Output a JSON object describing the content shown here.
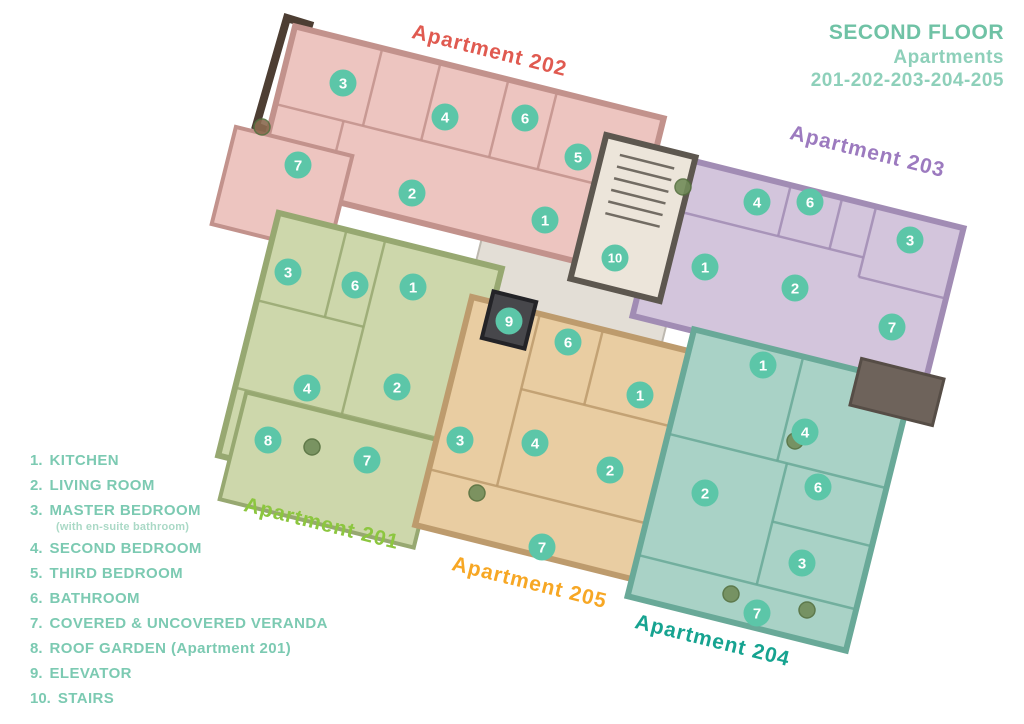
{
  "header": {
    "title": "SECOND FLOOR",
    "subtitle": "Apartments",
    "numbers": "201-202-203-204-205",
    "title_color": "#6fc2a5",
    "subtitle_color": "#8ed0ba"
  },
  "legend": {
    "color": "#7ccab2",
    "note_color": "#aad9c6",
    "items": [
      {
        "num": "1.",
        "text": "KITCHEN"
      },
      {
        "num": "2.",
        "text": "LIVING ROOM"
      },
      {
        "num": "3.",
        "text": "MASTER BEDROOM",
        "note": "(with en-suite bathroom)"
      },
      {
        "num": "4.",
        "text": "SECOND BEDROOM"
      },
      {
        "num": "5.",
        "text": "THIRD BEDROOM"
      },
      {
        "num": "6.",
        "text": "BATHROOM"
      },
      {
        "num": "7.",
        "text": "COVERED & UNCOVERED VERANDA"
      },
      {
        "num": "8.",
        "text": "ROOF GARDEN (Apartment 201)"
      },
      {
        "num": "9.",
        "text": "ELEVATOR"
      },
      {
        "num": "10.",
        "text": "STAIRS"
      }
    ]
  },
  "badge_style": {
    "fill": "#5cc6a8",
    "text_color": "#ffffff",
    "radius": 13.5
  },
  "floorplan": {
    "rotation_deg": 14,
    "context": [
      {
        "name": "common-corridor",
        "cx": 572,
        "cy": 290,
        "w": 200,
        "h": 100,
        "fill": "#e3ded6",
        "stroke": "#bdb8af"
      }
    ],
    "apartments": [
      {
        "id": "202",
        "label": "Apartment 202",
        "label_color": "#e05a50",
        "label_x": 488,
        "label_y": 57,
        "fill": "#edc5c0",
        "wall": "#c2928c",
        "cx": 460,
        "cy": 150,
        "w": 380,
        "h": 160,
        "wings": [
          {
            "cx": 282,
            "cy": 190,
            "w": 120,
            "h": 100
          }
        ],
        "dividers": [
          [
            -100,
            -80,
            -100,
            0
          ],
          [
            -40,
            -80,
            -40,
            0
          ],
          [
            30,
            -80,
            30,
            0
          ],
          [
            80,
            -80,
            80,
            0
          ],
          [
            -190,
            0,
            140,
            0
          ],
          [
            -120,
            0,
            -120,
            80
          ]
        ],
        "badges": [
          [
            "3",
            343,
            83
          ],
          [
            "4",
            445,
            117
          ],
          [
            "6",
            525,
            118
          ],
          [
            "5",
            578,
            157
          ],
          [
            "7",
            298,
            165
          ],
          [
            "2",
            412,
            193
          ],
          [
            "1",
            545,
            220
          ]
        ]
      },
      {
        "id": "203",
        "label": "Apartment 203",
        "label_color": "#9c7abf",
        "label_x": 866,
        "label_y": 158,
        "fill": "#d3c5dc",
        "wall": "#a18cb4",
        "cx": 798,
        "cy": 272,
        "w": 300,
        "h": 165,
        "wings": [],
        "dividers": [
          [
            -28,
            -82,
            -28,
            -30
          ],
          [
            25,
            -82,
            25,
            -30
          ],
          [
            -150,
            -30,
            60,
            -30
          ],
          [
            60,
            -82,
            60,
            -10
          ],
          [
            60,
            -10,
            150,
            -10
          ]
        ],
        "badges": [
          [
            "4",
            757,
            202
          ],
          [
            "6",
            810,
            202
          ],
          [
            "3",
            910,
            240
          ],
          [
            "1",
            705,
            267
          ],
          [
            "2",
            795,
            288
          ],
          [
            "7",
            892,
            327
          ]
        ]
      },
      {
        "id": "201",
        "label": "Apartment 201",
        "label_color": "#8cc63f",
        "label_x": 320,
        "label_y": 530,
        "fill": "#cdd7ab",
        "wall": "#97a871",
        "cx": 360,
        "cy": 362,
        "w": 230,
        "h": 250,
        "wings": [
          {
            "cx": 330,
            "cy": 470,
            "w": 200,
            "h": 110
          }
        ],
        "dividers": [
          [
            -115,
            -35,
            -5,
            -35
          ],
          [
            -45,
            -125,
            -45,
            -35
          ],
          [
            -5,
            -125,
            -5,
            55
          ],
          [
            -115,
            55,
            115,
            55
          ]
        ],
        "badges": [
          [
            "3",
            288,
            272
          ],
          [
            "6",
            355,
            285
          ],
          [
            "1",
            413,
            287
          ],
          [
            "4",
            307,
            388
          ],
          [
            "2",
            397,
            387
          ],
          [
            "8",
            268,
            440
          ],
          [
            "7",
            367,
            460
          ]
        ]
      },
      {
        "id": "205",
        "label": "Apartment 205",
        "label_color": "#f7a724",
        "label_x": 528,
        "label_y": 589,
        "fill": "#e9cda2",
        "wall": "#bd9b6d",
        "cx": 560,
        "cy": 440,
        "w": 240,
        "h": 235,
        "wings": [],
        "dividers": [
          [
            -120,
            60,
            120,
            60
          ],
          [
            -50,
            -118,
            -50,
            60
          ],
          [
            15,
            -118,
            15,
            -40
          ],
          [
            -50,
            -40,
            120,
            -40
          ]
        ],
        "badges": [
          [
            "6",
            568,
            342
          ],
          [
            "1",
            640,
            395
          ],
          [
            "3",
            460,
            440
          ],
          [
            "4",
            535,
            443
          ],
          [
            "2",
            610,
            470
          ],
          [
            "7",
            542,
            547
          ]
        ]
      },
      {
        "id": "204",
        "label": "Apartment 204",
        "label_color": "#16a390",
        "label_x": 711,
        "label_y": 647,
        "fill": "#a9d2c6",
        "wall": "#69a998",
        "cx": 770,
        "cy": 490,
        "w": 225,
        "h": 275,
        "wings": [],
        "dividers": [
          [
            -112,
            95,
            112,
            95
          ],
          [
            0,
            -137,
            0,
            -30
          ],
          [
            -112,
            -30,
            112,
            -30
          ],
          [
            10,
            -30,
            10,
            95
          ],
          [
            10,
            30,
            112,
            30
          ]
        ],
        "badges": [
          [
            "1",
            763,
            365
          ],
          [
            "4",
            805,
            432
          ],
          [
            "6",
            818,
            487
          ],
          [
            "2",
            705,
            493
          ],
          [
            "3",
            802,
            563
          ],
          [
            "7",
            757,
            613
          ]
        ]
      }
    ],
    "extras": [
      {
        "name": "roof-eave",
        "cx": 897,
        "cy": 392,
        "w": 85,
        "h": 48,
        "fill": "#6e635b",
        "stroke": "#564d46"
      }
    ],
    "stairs": {
      "name": "stairwell",
      "cx": 633,
      "cy": 218,
      "w": 92,
      "h": 148,
      "fill": "#ece5da",
      "wall": "#5d574f",
      "dividers": [
        [
          -28,
          -58,
          28,
          -58
        ],
        [
          -28,
          -46,
          28,
          -46
        ],
        [
          -28,
          -34,
          28,
          -34
        ],
        [
          -28,
          -22,
          28,
          -22
        ],
        [
          -28,
          -10,
          28,
          -10
        ],
        [
          -28,
          2,
          28,
          2
        ]
      ],
      "badge": [
        "10",
        615,
        258
      ]
    },
    "elevator": {
      "name": "elevator-shaft",
      "cx": 509,
      "cy": 320,
      "w": 44,
      "h": 48,
      "fill": "#47474b",
      "wall": "#232327",
      "badge": [
        "9",
        509,
        321
      ]
    },
    "balcony": {
      "points": "313,26 287,18 256,126 268,131",
      "color": "#4d3e33"
    },
    "plants": [
      {
        "x": 262,
        "y": 127,
        "color": "#8a6a4f"
      },
      {
        "x": 683,
        "y": 187,
        "color": "#718c59"
      },
      {
        "x": 795,
        "y": 441,
        "color": "#718c59"
      },
      {
        "x": 312,
        "y": 447,
        "color": "#718c59"
      },
      {
        "x": 477,
        "y": 493,
        "color": "#718c59"
      },
      {
        "x": 731,
        "y": 594,
        "color": "#718c59"
      },
      {
        "x": 807,
        "y": 610,
        "color": "#718c59"
      }
    ]
  }
}
